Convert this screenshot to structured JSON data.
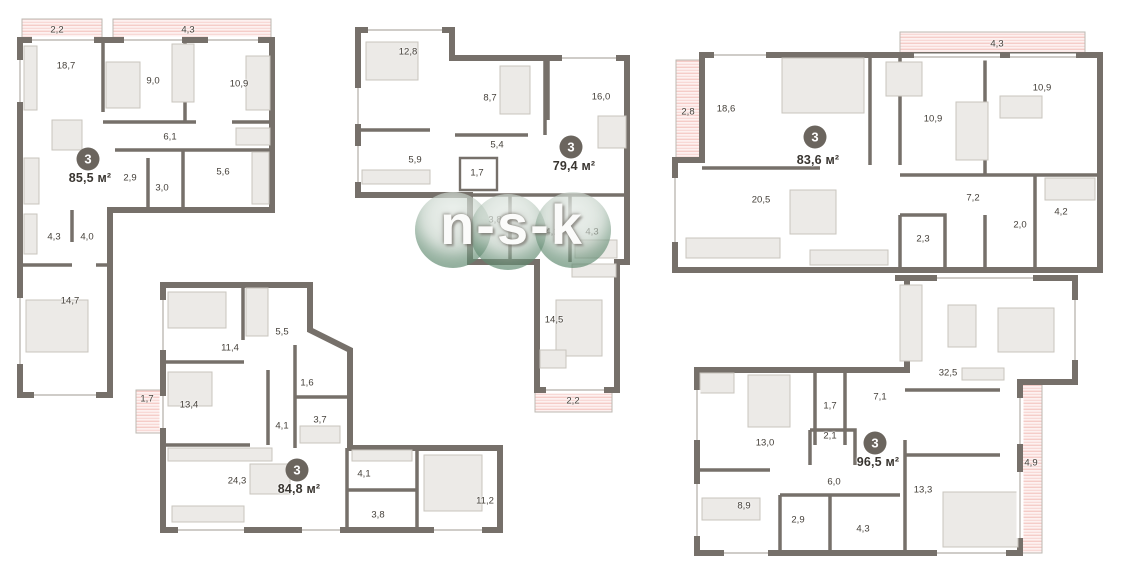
{
  "watermark": {
    "text": "n-s-k"
  },
  "plans": {
    "p1": {
      "badge": "3",
      "area": "85,5 м²",
      "rooms": [
        "18,7",
        "9,0",
        "10,9",
        "6,1",
        "2,9",
        "3,0",
        "5,6",
        "4,3",
        "4,0",
        "14,7"
      ],
      "balconies": [
        "2,2",
        "4,3"
      ]
    },
    "p2": {
      "badge": "3",
      "area": "79,4 м²",
      "rooms": [
        "12,8",
        "8,7",
        "16,0",
        "5,9",
        "5,4",
        "1,7",
        "3,8",
        "4,1",
        "4,3",
        "14,5"
      ],
      "balconies": [
        "2,2"
      ]
    },
    "p3": {
      "badge": "3",
      "area": "83,6 м²",
      "rooms": [
        "18,6",
        "10,9",
        "10,9",
        "20,5",
        "7,2",
        "2,3",
        "2,0",
        "4,2"
      ],
      "balconies": [
        "4,3",
        "2,8"
      ]
    },
    "p4": {
      "badge": "3",
      "area": "84,8 м²",
      "rooms": [
        "11,4",
        "5,5",
        "1,6",
        "13,4",
        "3,7",
        "4,1",
        "24,3",
        "4,1",
        "3,8",
        "11,2"
      ],
      "balconies": [
        "1,7"
      ]
    },
    "p5": {
      "badge": "3",
      "area": "96,5 м²",
      "rooms": [
        "32,5",
        "1,7",
        "7,1",
        "13,0",
        "2,1",
        "6,0",
        "13,3",
        "8,9",
        "2,9",
        "4,3"
      ],
      "balconies": [
        "4,9"
      ]
    }
  }
}
